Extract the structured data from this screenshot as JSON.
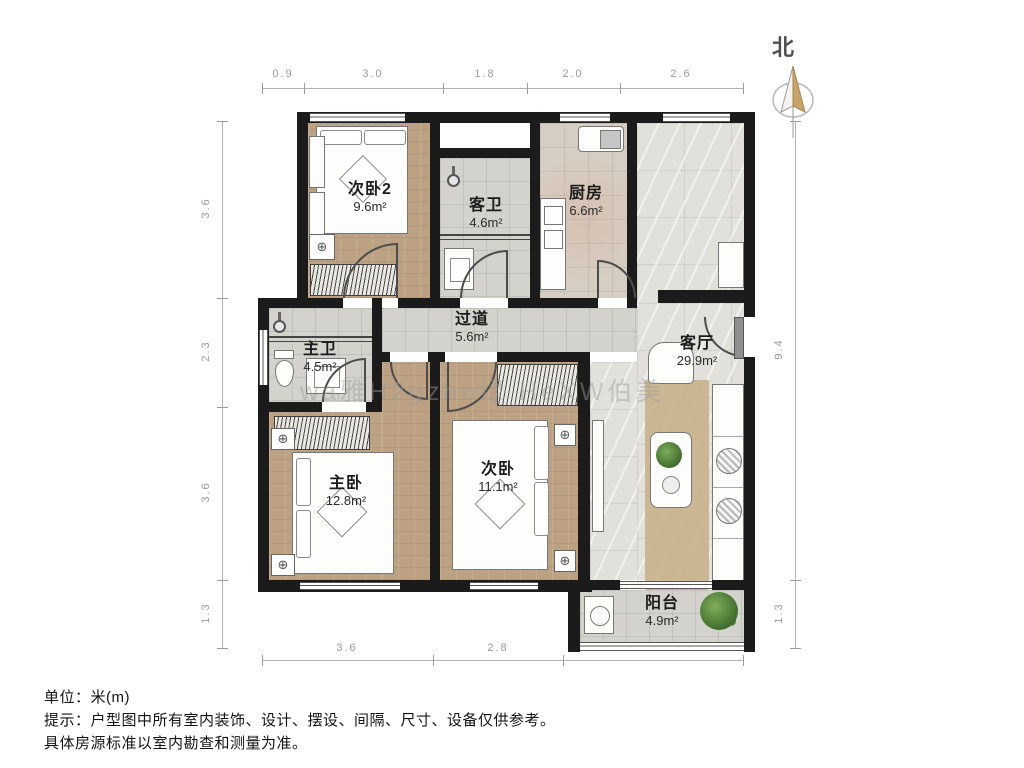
{
  "north": {
    "label": "北"
  },
  "rooms": [
    {
      "name": "次卧2",
      "area": "9.6m²"
    },
    {
      "name": "客卫",
      "area": "4.6m²"
    },
    {
      "name": "厨房",
      "area": "6.6m²"
    },
    {
      "name": "过道",
      "area": "5.6m²"
    },
    {
      "name": "主卫",
      "area": "4.5m²"
    },
    {
      "name": "客厅",
      "area": "29.9m²"
    },
    {
      "name": "主卧",
      "area": "12.8m²"
    },
    {
      "name": "次卧",
      "area": "11.1m²"
    },
    {
      "name": "阳台",
      "area": "4.9m²"
    }
  ],
  "dimensions": {
    "top": [
      "0.9",
      "3.0",
      "1.8",
      "2.0",
      "2.6"
    ],
    "left": [
      "3.6",
      "2.3",
      "3.6",
      "1.3"
    ],
    "right": [
      "9.4",
      "1.3"
    ],
    "bottom": [
      "3.6",
      "2.8",
      "3.8"
    ]
  },
  "watermark": {
    "text": "wa雅H2gzho绿 HeXW伯美"
  },
  "footer": {
    "line1": "单位：米(m)",
    "line2": "提示：户型图中所有室内装饰、设计、摆设、间隔、尺寸、设备仅供参考。",
    "line3": "具体房源标准以室内勘查和测量为准。"
  },
  "icons": {
    "ac_unit": "⊕"
  },
  "colors": {
    "wall": "#1b1b1b",
    "wood_floor": "#bda183",
    "tile_floor": "#d3d2cc",
    "large_tile_floor": "#e1e0da",
    "rug": "#c9b18c",
    "compass_tan": "#c8a36b",
    "dimension_text": "#9a9a9a"
  }
}
